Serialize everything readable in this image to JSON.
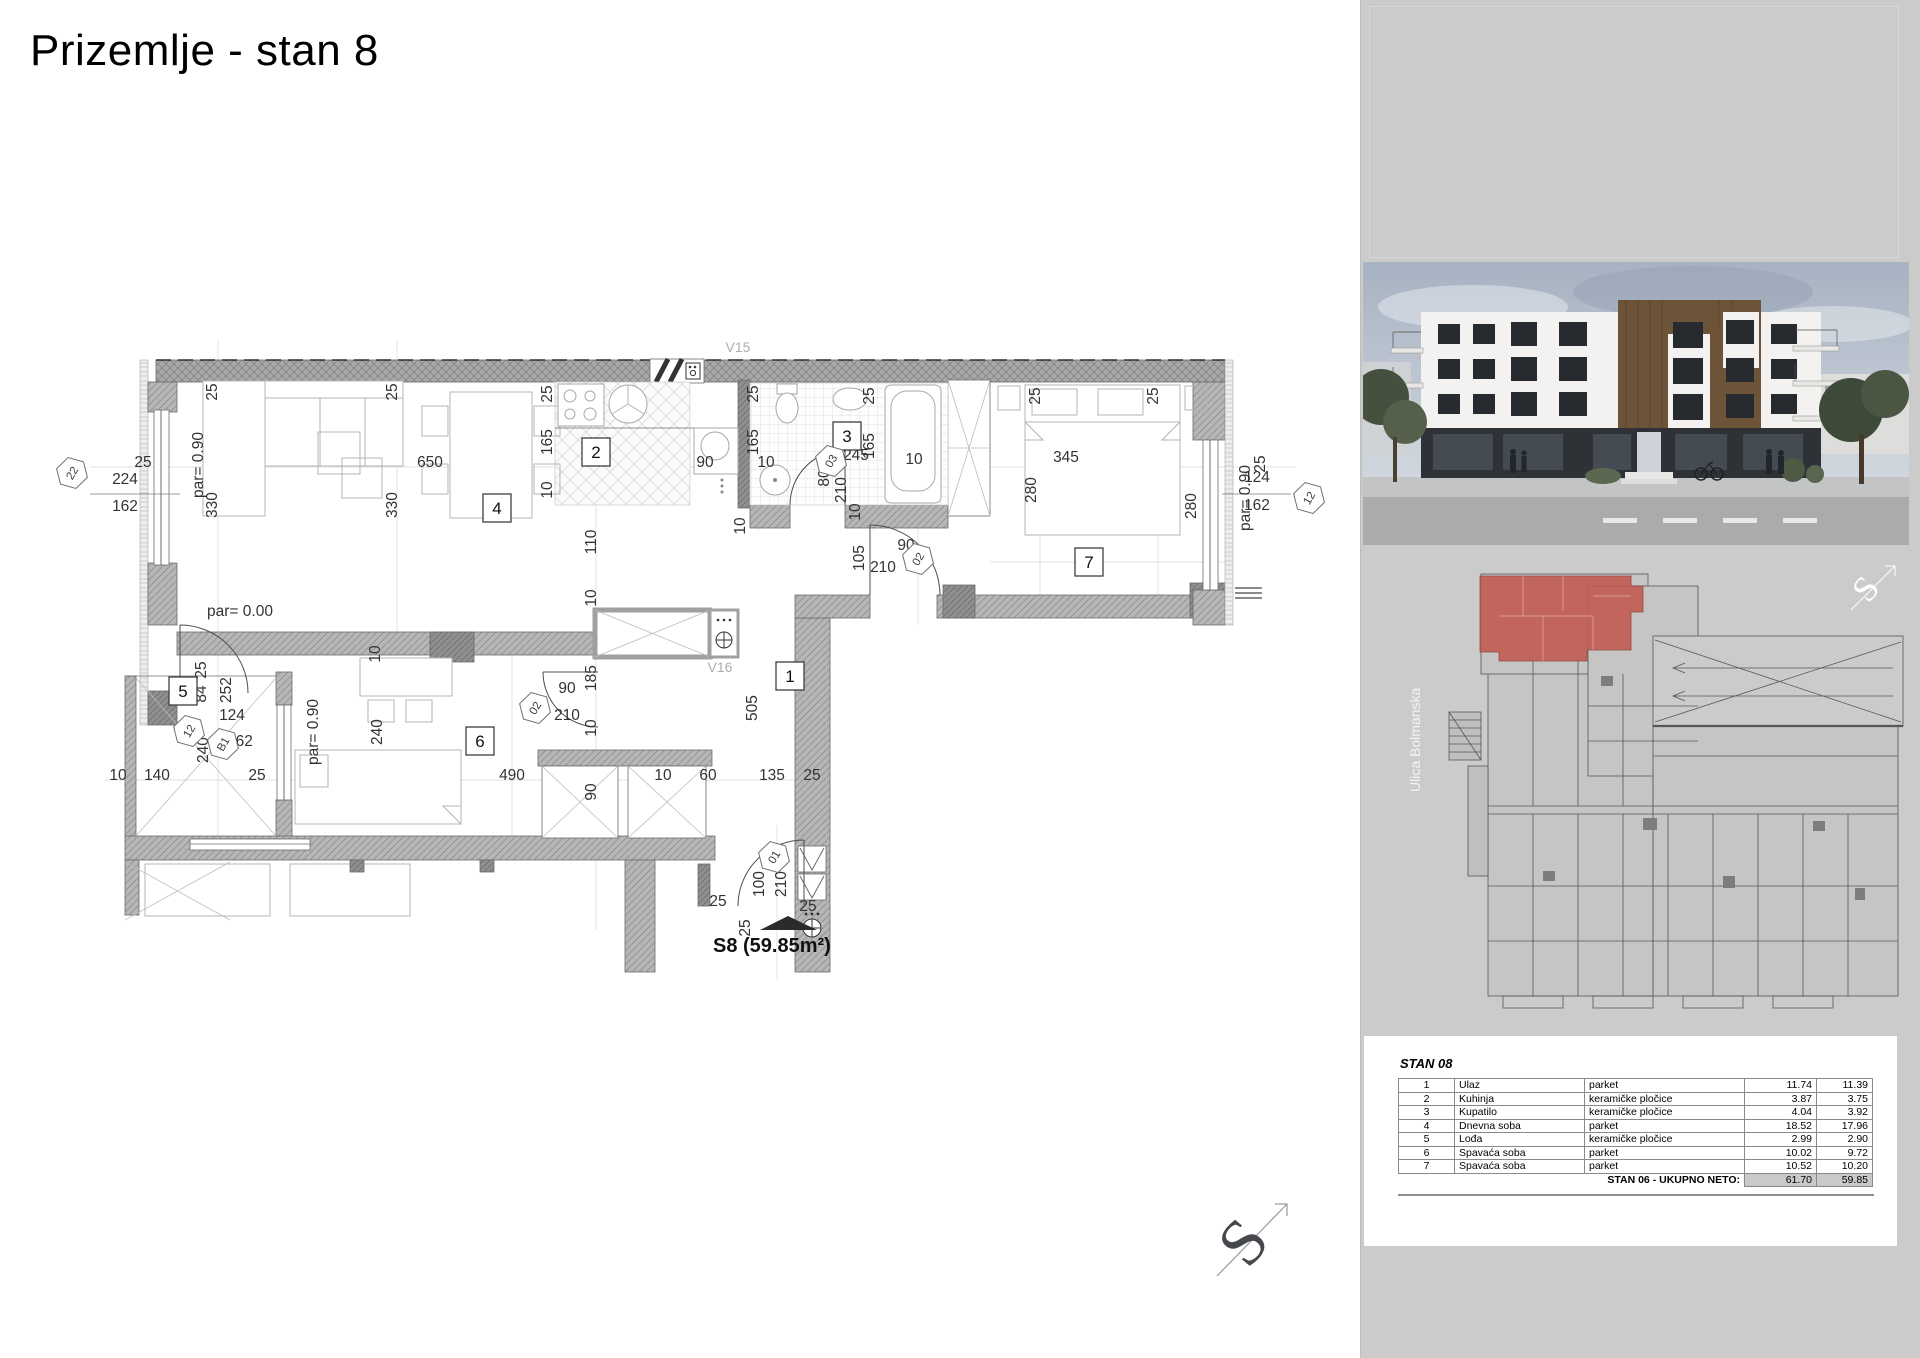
{
  "page": {
    "title": "Prizemlje - stan 8"
  },
  "plan": {
    "unit_label": "S8 (59.85m²)",
    "compass_letter": "S",
    "vents": [
      {
        "t": "V15",
        "x": 688,
        "y": 72
      },
      {
        "t": "V16",
        "x": 670,
        "y": 392
      }
    ],
    "room_numbers": [
      {
        "n": "1",
        "x": 740,
        "y": 396
      },
      {
        "n": "2",
        "x": 546,
        "y": 172
      },
      {
        "n": "3",
        "x": 797,
        "y": 156
      },
      {
        "n": "4",
        "x": 447,
        "y": 228
      },
      {
        "n": "5",
        "x": 133,
        "y": 411
      },
      {
        "n": "6",
        "x": 430,
        "y": 461
      },
      {
        "n": "7",
        "x": 1039,
        "y": 282
      }
    ],
    "hex_markers": [
      {
        "t": "22",
        "x": 22,
        "y": 193
      },
      {
        "t": "12",
        "x": 1259,
        "y": 218
      },
      {
        "t": "12",
        "x": 139,
        "y": 451
      },
      {
        "t": "B1",
        "x": 173,
        "y": 464
      },
      {
        "t": "02",
        "x": 485,
        "y": 428
      },
      {
        "t": "02",
        "x": 868,
        "y": 279
      },
      {
        "t": "03",
        "x": 781,
        "y": 181
      },
      {
        "t": "01",
        "x": 724,
        "y": 577
      }
    ],
    "dims": [
      {
        "t": "25",
        "x": 93,
        "y": 187
      },
      {
        "t": "224",
        "x": 75,
        "y": 204
      },
      {
        "t": "162",
        "x": 75,
        "y": 231
      },
      {
        "t": "par= 0.90",
        "x": 153,
        "y": 185,
        "r": -90
      },
      {
        "t": "330",
        "x": 167,
        "y": 225,
        "r": -90
      },
      {
        "t": "25",
        "x": 167,
        "y": 112,
        "r": -90
      },
      {
        "t": "330",
        "x": 347,
        "y": 225,
        "r": -90
      },
      {
        "t": "25",
        "x": 347,
        "y": 112,
        "r": -90
      },
      {
        "t": "650",
        "x": 380,
        "y": 187
      },
      {
        "t": "par= 0.00",
        "x": 190,
        "y": 336
      },
      {
        "t": "25",
        "x": 502,
        "y": 114,
        "r": -90
      },
      {
        "t": "165",
        "x": 502,
        "y": 162,
        "r": -90
      },
      {
        "t": "10",
        "x": 502,
        "y": 210,
        "r": -90
      },
      {
        "t": "90",
        "x": 655,
        "y": 187
      },
      {
        "t": "110",
        "x": 546,
        "y": 262,
        "r": -90
      },
      {
        "t": "10",
        "x": 546,
        "y": 318,
        "r": -90
      },
      {
        "t": "185",
        "x": 546,
        "y": 398,
        "r": -90
      },
      {
        "t": "10",
        "x": 546,
        "y": 448,
        "r": -90
      },
      {
        "t": "90",
        "x": 546,
        "y": 512,
        "r": -90
      },
      {
        "t": "25",
        "x": 708,
        "y": 114,
        "r": -90
      },
      {
        "t": "165",
        "x": 708,
        "y": 162,
        "r": -90
      },
      {
        "t": "10",
        "x": 716,
        "y": 187
      },
      {
        "t": "245",
        "x": 806,
        "y": 180
      },
      {
        "t": "10",
        "x": 864,
        "y": 184
      },
      {
        "t": "165",
        "x": 824,
        "y": 166,
        "r": -90
      },
      {
        "t": "25",
        "x": 824,
        "y": 116,
        "r": -90
      },
      {
        "t": "80",
        "x": 779,
        "y": 198,
        "r": -90
      },
      {
        "t": "210",
        "x": 796,
        "y": 210,
        "r": -90
      },
      {
        "t": "10",
        "x": 810,
        "y": 232,
        "r": -90
      },
      {
        "t": "10",
        "x": 695,
        "y": 246,
        "r": -90
      },
      {
        "t": "105",
        "x": 814,
        "y": 278,
        "r": -90
      },
      {
        "t": "210",
        "x": 833,
        "y": 292
      },
      {
        "t": "90",
        "x": 856,
        "y": 270
      },
      {
        "t": "505",
        "x": 707,
        "y": 428,
        "r": -90
      },
      {
        "t": "10",
        "x": 613,
        "y": 500
      },
      {
        "t": "60",
        "x": 658,
        "y": 500
      },
      {
        "t": "135",
        "x": 722,
        "y": 500
      },
      {
        "t": "25",
        "x": 762,
        "y": 500
      },
      {
        "t": "par= 0.90",
        "x": 268,
        "y": 452,
        "r": -90
      },
      {
        "t": "240",
        "x": 332,
        "y": 452,
        "r": -90
      },
      {
        "t": "10",
        "x": 330,
        "y": 374,
        "r": -90
      },
      {
        "t": "490",
        "x": 462,
        "y": 500
      },
      {
        "t": "90",
        "x": 517,
        "y": 413
      },
      {
        "t": "210",
        "x": 517,
        "y": 440
      },
      {
        "t": "25",
        "x": 156,
        "y": 390,
        "r": -90
      },
      {
        "t": "84",
        "x": 156,
        "y": 414,
        "r": -90
      },
      {
        "t": "252",
        "x": 181,
        "y": 410,
        "r": -90
      },
      {
        "t": "124",
        "x": 182,
        "y": 440
      },
      {
        "t": "162",
        "x": 190,
        "y": 466
      },
      {
        "t": "240",
        "x": 158,
        "y": 470,
        "r": -90
      },
      {
        "t": "10",
        "x": 68,
        "y": 500
      },
      {
        "t": "140",
        "x": 107,
        "y": 500
      },
      {
        "t": "25",
        "x": 207,
        "y": 500
      },
      {
        "t": "345",
        "x": 1016,
        "y": 182
      },
      {
        "t": "280",
        "x": 986,
        "y": 210,
        "r": -90
      },
      {
        "t": "280",
        "x": 1146,
        "y": 226,
        "r": -90
      },
      {
        "t": "25",
        "x": 990,
        "y": 116,
        "r": -90
      },
      {
        "t": "25",
        "x": 1108,
        "y": 116,
        "r": -90
      },
      {
        "t": "par= 0.90",
        "x": 1200,
        "y": 218,
        "r": -90
      },
      {
        "t": "25",
        "x": 1215,
        "y": 184,
        "r": -90
      },
      {
        "t": "124",
        "x": 1207,
        "y": 202
      },
      {
        "t": "162",
        "x": 1207,
        "y": 230
      },
      {
        "t": "100",
        "x": 714,
        "y": 604,
        "r": -90
      },
      {
        "t": "210",
        "x": 736,
        "y": 604,
        "r": -90
      },
      {
        "t": "25",
        "x": 668,
        "y": 626
      },
      {
        "t": "25",
        "x": 758,
        "y": 631
      },
      {
        "t": "25",
        "x": 700,
        "y": 648,
        "r": -90
      }
    ]
  },
  "sidebar": {
    "street_label": "Ulica Bolmanska",
    "compass_letter": "S",
    "table": {
      "title": "STAN 08",
      "rows": [
        [
          "1",
          "Ulaz",
          "parket",
          "11.74",
          "11.39"
        ],
        [
          "2",
          "Kuhinja",
          "keramičke pločice",
          "3.87",
          "3.75"
        ],
        [
          "3",
          "Kupatilo",
          "keramičke pločice",
          "4.04",
          "3.92"
        ],
        [
          "4",
          "Dnevna soba",
          "parket",
          "18.52",
          "17.96"
        ],
        [
          "5",
          "Lođa",
          "keramičke pločice",
          "2.99",
          "2.90"
        ],
        [
          "6",
          "Spavaća soba",
          "parket",
          "10.02",
          "9.72"
        ],
        [
          "7",
          "Spavaća soba",
          "parket",
          "10.52",
          "10.20"
        ]
      ],
      "total_label": "STAN 06 - UKUPNO NETO:",
      "total_values": [
        "61.70",
        "59.85"
      ]
    }
  },
  "colors": {
    "highlight_red": "#c25a4f",
    "panel_gray": "#cbcbcb"
  }
}
